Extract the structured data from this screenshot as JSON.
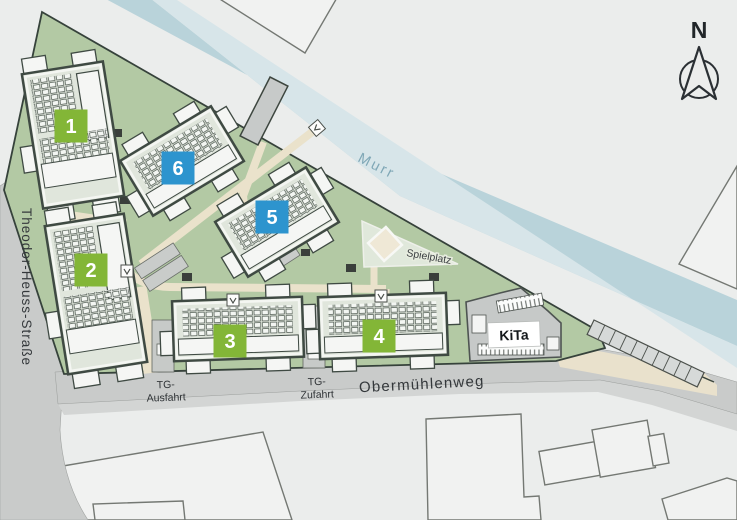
{
  "map": {
    "labels": {
      "river": "Murr",
      "street_left": "Theodor-Heuss-Straße",
      "street_bottom": "Obermühlenweg",
      "tg_exit_line1": "TG-",
      "tg_exit_line2": "Ausfahrt",
      "tg_entry_line1": "TG-",
      "tg_entry_line2": "Zufahrt",
      "playground": "Spielplatz",
      "kita": "KiTa",
      "north": "N"
    },
    "buildings": [
      {
        "id": "1",
        "number": "1",
        "badge": "green",
        "cx": 73,
        "cy": 135,
        "w": 82,
        "h": 136,
        "angle": -9,
        "ldx": -2,
        "ldy": -9,
        "portrait": true
      },
      {
        "id": "2",
        "number": "2",
        "badge": "green",
        "cx": 96,
        "cy": 294,
        "w": 80,
        "h": 150,
        "angle": -9,
        "ldx": -5,
        "ldy": -24,
        "portrait": true
      },
      {
        "id": "3",
        "number": "3",
        "badge": "green",
        "cx": 238,
        "cy": 329,
        "w": 130,
        "h": 60,
        "angle": -2,
        "ldx": -8,
        "ldy": 12,
        "portrait": false
      },
      {
        "id": "4",
        "number": "4",
        "badge": "green",
        "cx": 383,
        "cy": 326,
        "w": 128,
        "h": 62,
        "angle": -2,
        "ldx": -4,
        "ldy": 10,
        "portrait": false
      },
      {
        "id": "5",
        "number": "5",
        "badge": "blue",
        "cx": 277,
        "cy": 222,
        "w": 106,
        "h": 64,
        "angle": -31,
        "ldx": -5,
        "ldy": -5,
        "portrait": false
      },
      {
        "id": "6",
        "number": "6",
        "badge": "blue",
        "cx": 182,
        "cy": 161,
        "w": 106,
        "h": 64,
        "angle": -31,
        "ldx": -4,
        "ldy": 7,
        "portrait": false
      }
    ],
    "colors": {
      "background": "#ebedec",
      "site_green": "#b3c9a4",
      "river_blue": "#b9d3da",
      "river_light": "#d7e5e9",
      "road_gray": "#c9cbca",
      "sidewalk_gray": "#d3d5d4",
      "path_beige": "#eae2cb",
      "sand": "#e9e1cc",
      "roof": "#e0e6dc",
      "building_outline": "#3f4a43",
      "badge_green": "#83b637",
      "badge_blue": "#2d94ce",
      "kita_gray": "#c6c9c8",
      "text_dark": "#34383b",
      "river_text": "#7fa7b6"
    }
  }
}
